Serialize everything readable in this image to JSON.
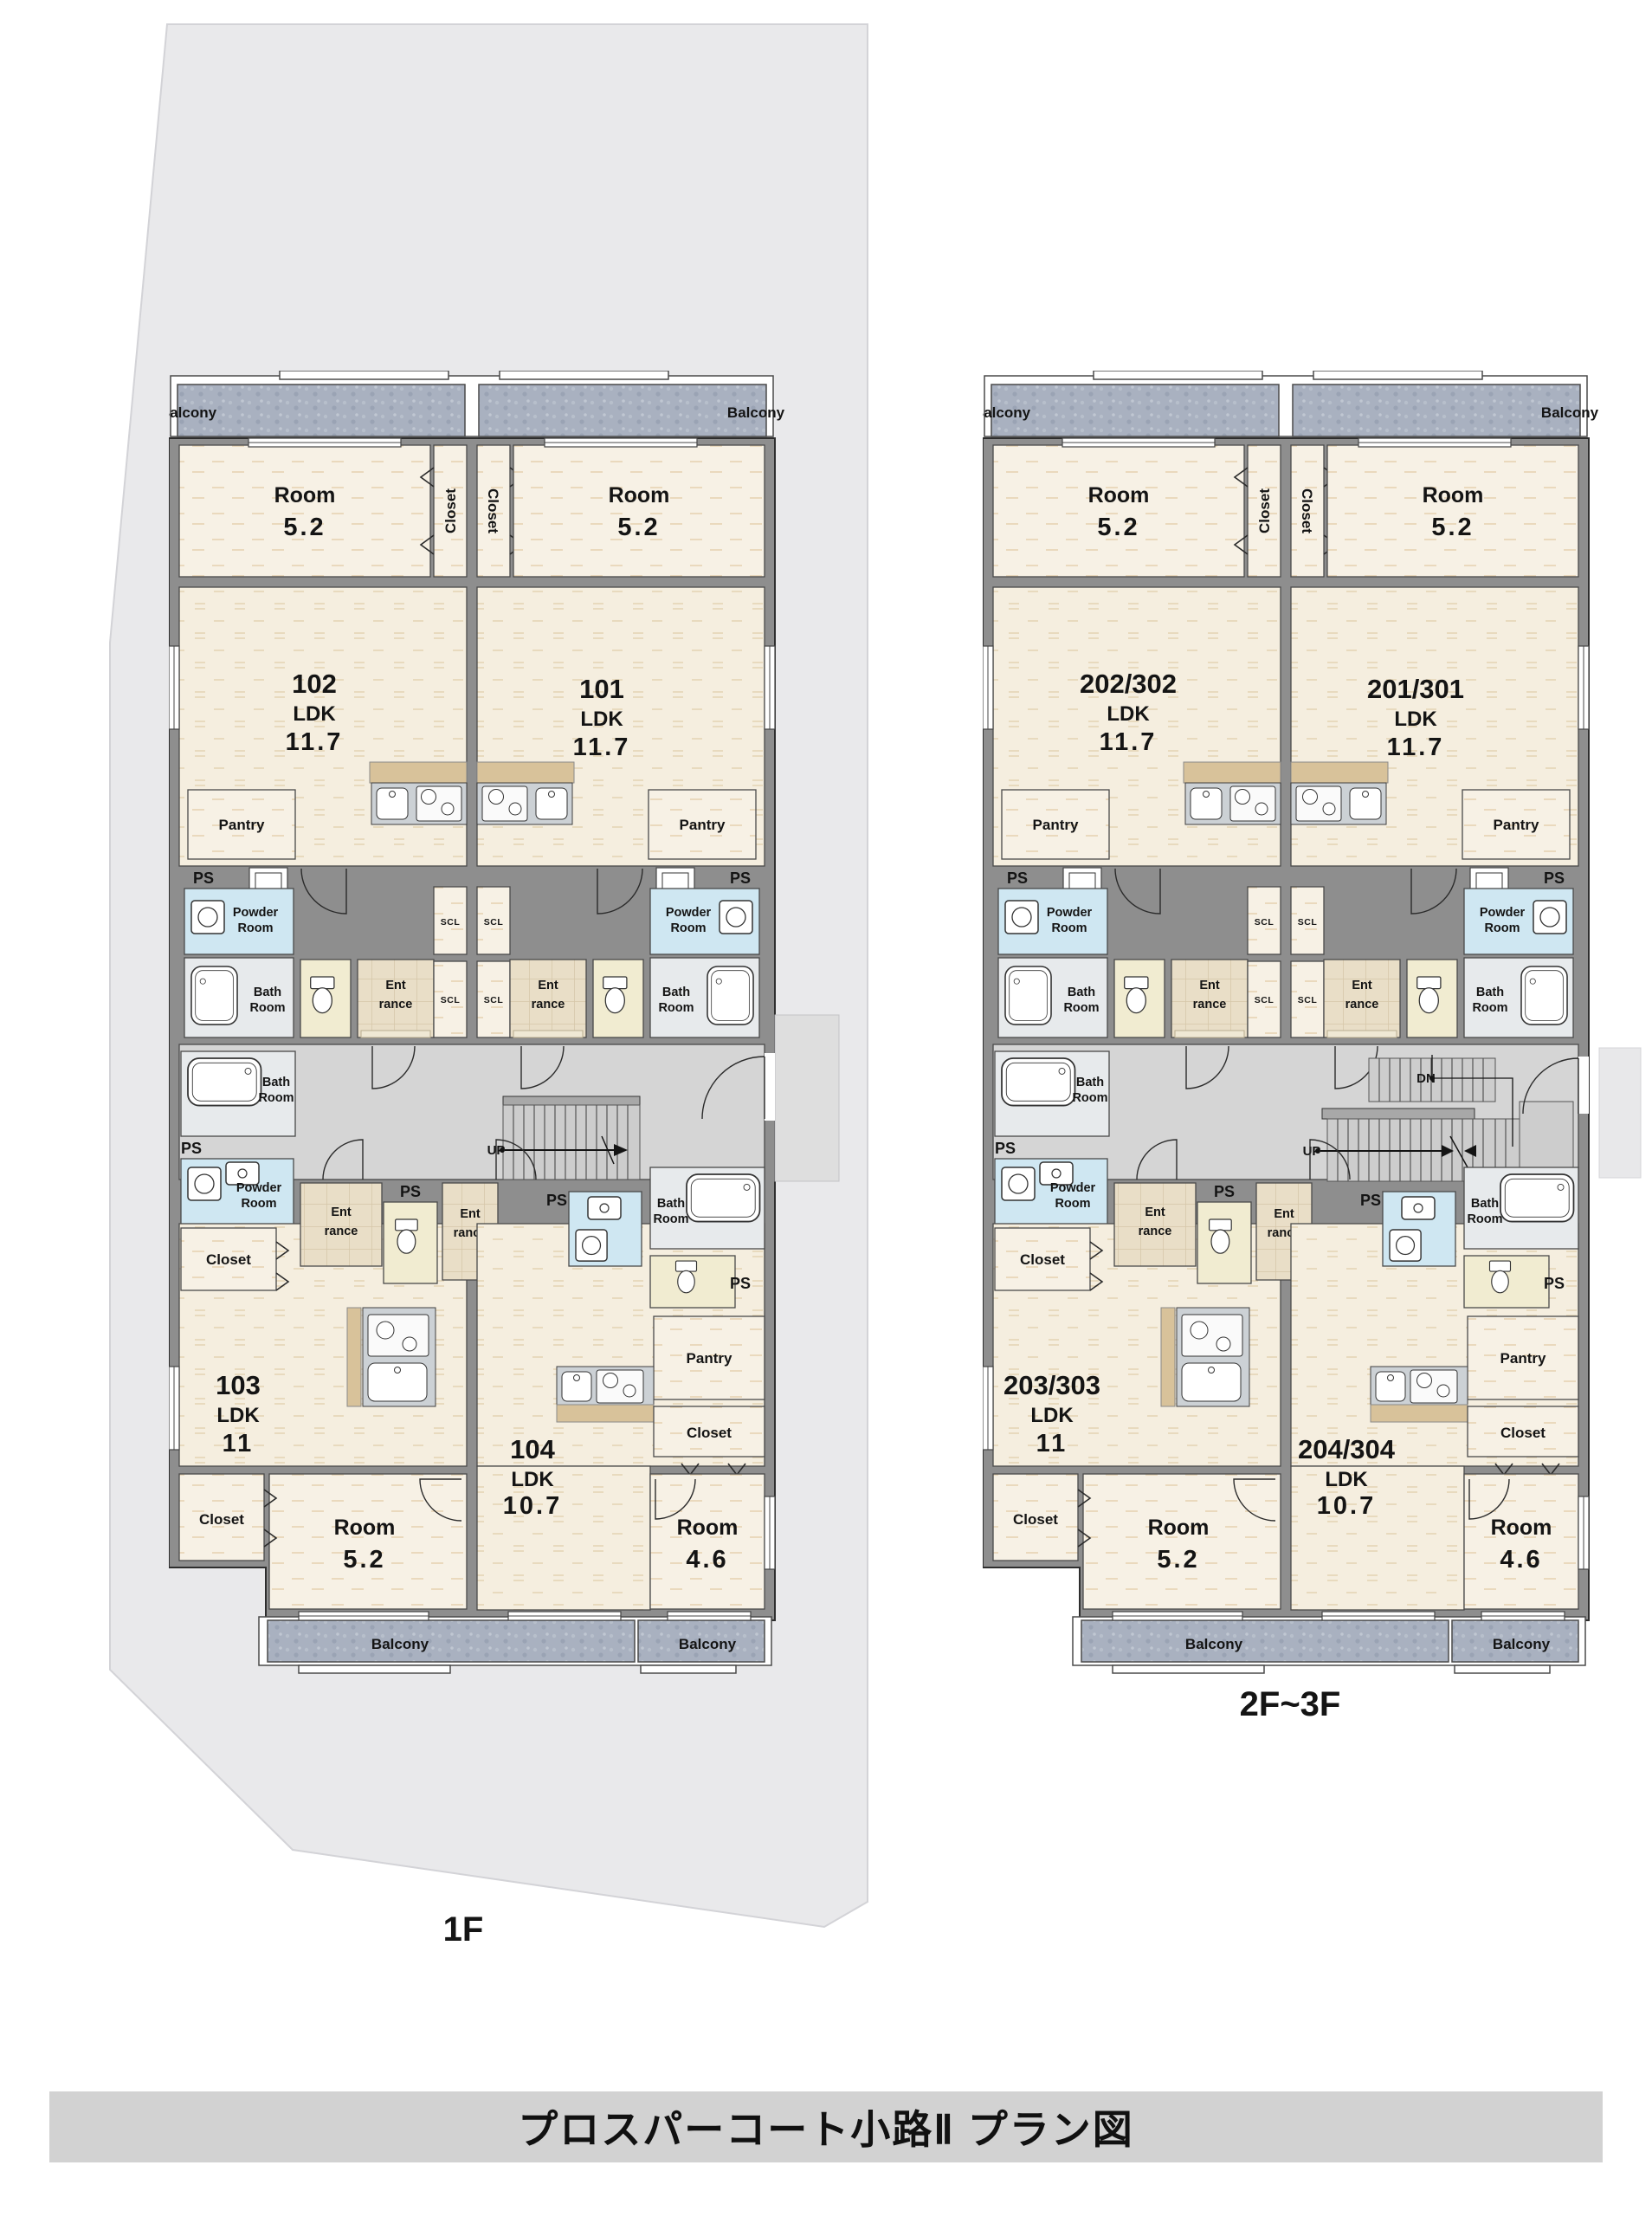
{
  "title": "プロスパーコート小路Ⅱ プラン図",
  "labels": {
    "balcony": "Balcony",
    "room": "Room",
    "closet": "Closet",
    "pantry": "Pantry",
    "ps": "PS",
    "powder_l1": "Powder",
    "powder_l2": "Room",
    "bath_l1": "Bath",
    "bath_l2": "Room",
    "ent_l1": "Ent",
    "ent_l2": "rance",
    "scl": "SCL",
    "up": "UP",
    "dn": "DN",
    "ldk": "LDK"
  },
  "plans": {
    "f1": {
      "caption": "1F",
      "units": {
        "upper_left": {
          "no": "102",
          "ldk_size": "11.7",
          "room_size": "5.2"
        },
        "upper_right": {
          "no": "101",
          "ldk_size": "11.7",
          "room_size": "5.2"
        },
        "lower_left": {
          "no": "103",
          "ldk_size": "11",
          "room_size": "5.2"
        },
        "lower_mid": {
          "no": "104",
          "ldk_size": "10.7",
          "room_size": "4.6"
        }
      }
    },
    "f23": {
      "caption": "2F~3F",
      "units": {
        "upper_left": {
          "no": "202/302",
          "ldk_size": "11.7",
          "room_size": "5.2"
        },
        "upper_right": {
          "no": "201/301",
          "ldk_size": "11.7",
          "room_size": "5.2"
        },
        "lower_left": {
          "no": "203/303",
          "ldk_size": "11",
          "room_size": "5.2"
        },
        "lower_mid": {
          "no": "204/304",
          "ldk_size": "10.7",
          "room_size": "4.6"
        }
      }
    }
  }
}
